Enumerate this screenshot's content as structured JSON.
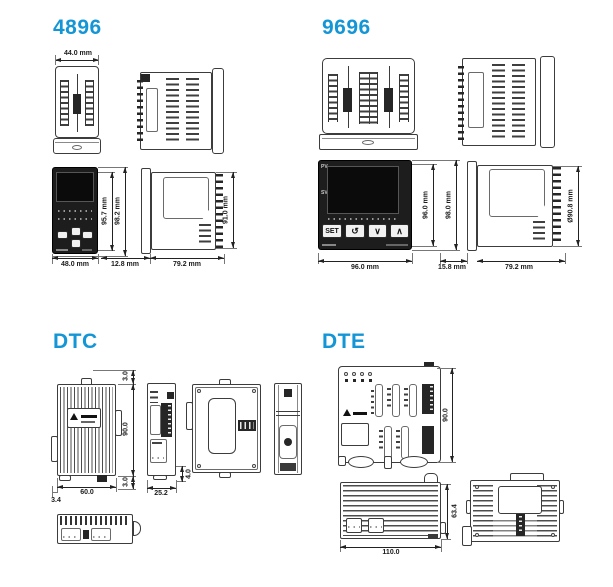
{
  "colors": {
    "accent": "#1495d6",
    "line": "#3c3c3c"
  },
  "s4896": {
    "title": "4896",
    "dim_top_width": "44.0 mm",
    "dim_front_width": "48.0 mm",
    "dim_front_h_inner": "95.7 mm",
    "dim_front_h_outer": "98.2 mm",
    "dim_bezel_depth": "12.8 mm",
    "dim_body_depth": "79.2 mm",
    "dim_side_height": "91.0 mm"
  },
  "s9696": {
    "title": "9696",
    "dim_front_width": "96.0 mm",
    "dim_front_h_inner": "96.0 mm",
    "dim_front_h_outer": "98.0 mm",
    "dim_bezel_depth": "15.8 mm",
    "dim_body_depth": "79.2 mm",
    "dim_side_height": "Ø90.8 mm",
    "panel": {
      "pv": "PV",
      "sv": "SV",
      "btn_set": "SET",
      "btn_loop": "↺",
      "btn_down": "∨",
      "btn_up": "∧"
    }
  },
  "dtc": {
    "title": "DTC",
    "dim_top_offset": "3.0",
    "dim_height": "90.0",
    "dim_bottom_offset": "3.0",
    "dim_width": "60.0",
    "dim_foot_offset": "3.4",
    "dim_side_width": "25.2",
    "dim_clip_height": "4.0"
  },
  "dte": {
    "title": "DTE",
    "dim_height": "90.0",
    "dim_width": "110.0",
    "dim_depth": "63.4"
  }
}
